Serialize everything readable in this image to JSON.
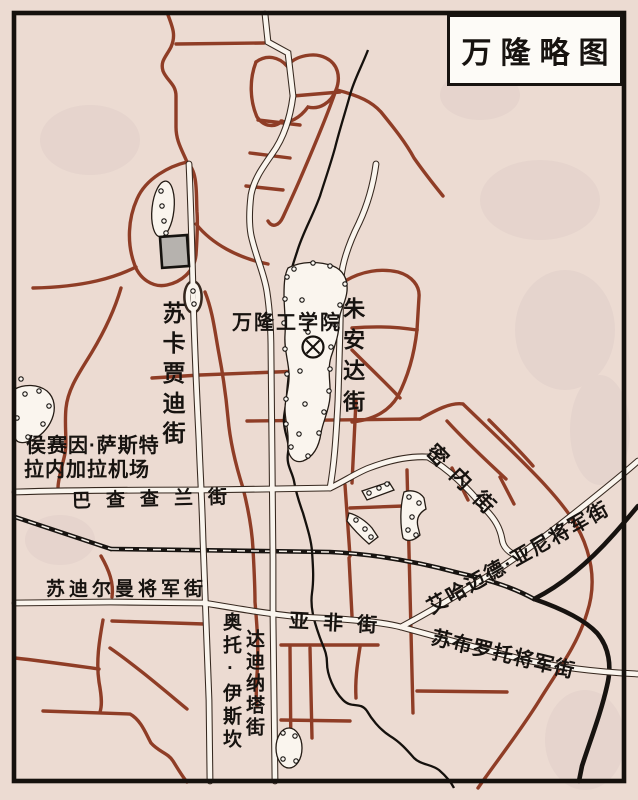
{
  "map": {
    "title": "万隆略图",
    "labels": {
      "institute": "万隆工学院",
      "sukajadi": "苏卡贾迪街",
      "juanda": "朱安达街",
      "airport_line1": "侯赛因·萨斯特",
      "airport_line2": "拉内加拉机场",
      "pajajaran": "巴查查兰街",
      "minei": "密内街",
      "ahmad_yani": "艾哈迈德·亚尼将军街",
      "sudirman": "苏迪尔曼将军街",
      "asia_africa": "亚非街",
      "subroto": "苏布罗托将军街",
      "otto_line1": "奥托·伊斯坎",
      "otto_line2": "达迪纳塔街"
    },
    "symbols": {
      "institute_symbol": "circle-x-school-symbol",
      "dotted_areas": "park-campus-dotted-boundary",
      "gray_block": "building-block",
      "railway": "railway-line",
      "river": "river-line"
    },
    "colors": {
      "paper": "#ecdbd2",
      "secondary_road_brown": "#8f3d26",
      "major_road_white": "#faf5ee",
      "railway_black": "#171310",
      "building_gray": "#b6b2ae"
    }
  }
}
